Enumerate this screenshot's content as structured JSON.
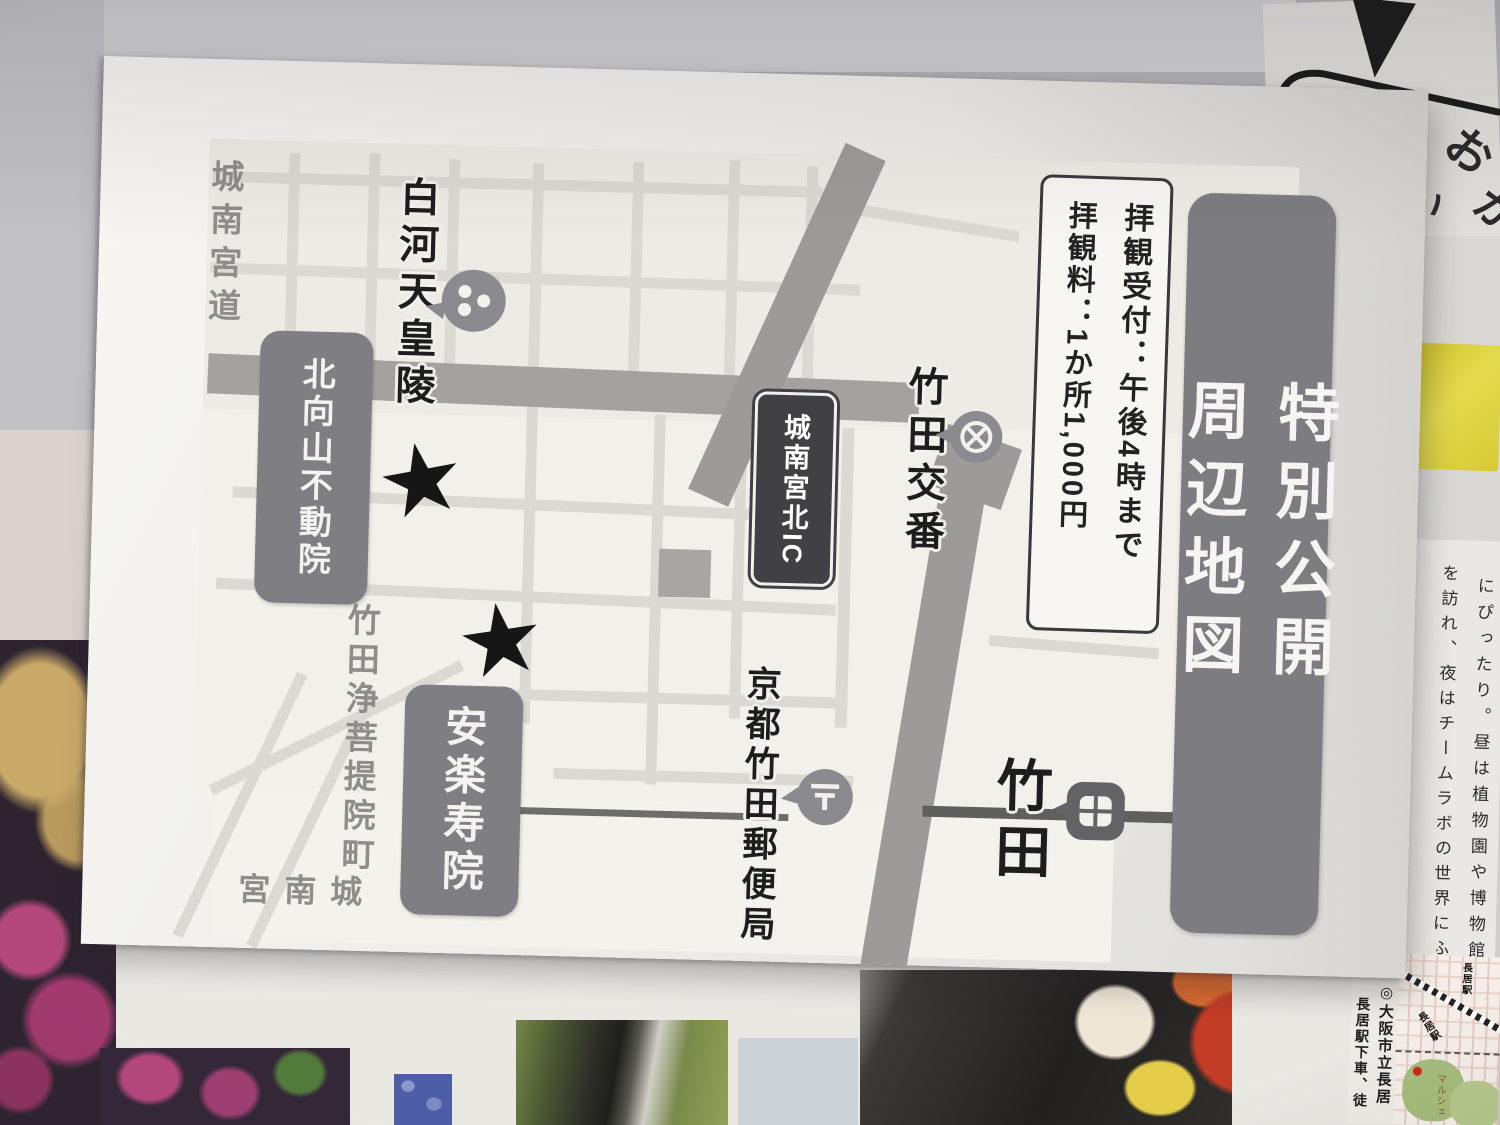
{
  "flyer": {
    "title": "特別公開　周辺地図",
    "info_box": {
      "reception": "拝観受付：午後4時まで",
      "fee": "拝観料：1か所1,000円"
    },
    "map": {
      "road_label": "城南宮道",
      "tomb_label": "白河天皇陵",
      "fudoin_label": "北向山不動院",
      "ic_label": "城南宮北IC",
      "koban_label": "竹田交番",
      "street_label": "竹田浄菩提院町",
      "anrakujuin_label": "安楽寿院",
      "post_office_label": "京都竹田郵便局",
      "station_label": "竹田",
      "jonangu_label": "城南宮",
      "star_glyph": "★"
    }
  },
  "background": {
    "right_page": {
      "col1": "にぴったり。昼は植物園や博物館",
      "col2": "を訪れ、夜はチームラボの世界にふ"
    },
    "corner_map": {
      "caption_col1": "◎大阪市立長居",
      "caption_col2": "長居駅下車、徒",
      "station_a": "長居駅",
      "station_b": "長居駅",
      "note": "マルシェ"
    },
    "bubble": {
      "frag1": "お",
      "frag2": "が",
      "frag3": "い"
    }
  },
  "colors": {
    "flyer_paper": "#f2f1ed",
    "label_gray": "#7f7e82",
    "road_gray": "#a3a29e",
    "ink": "#1d1d1d",
    "sticker_yellow": "#ddd23a",
    "flower_pink": "#b2487c"
  }
}
